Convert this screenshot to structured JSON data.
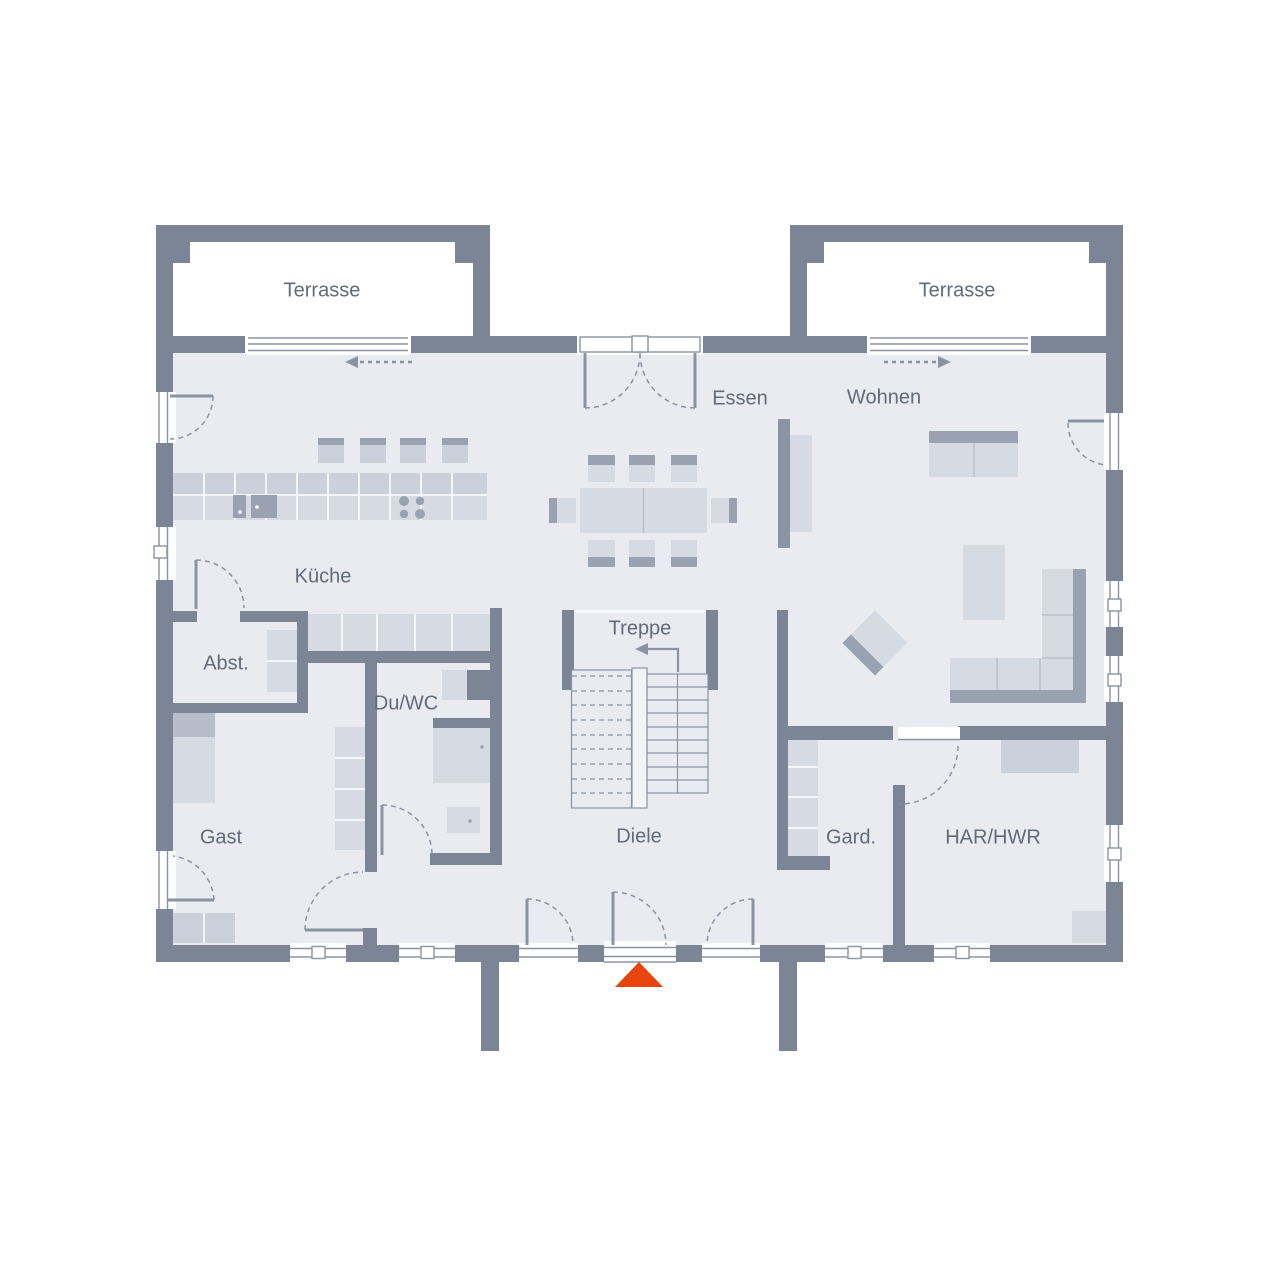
{
  "rooms": {
    "terrasse_left": "Terrasse",
    "terrasse_right": "Terrasse",
    "essen": "Essen",
    "wohnen": "Wohnen",
    "kueche": "Küche",
    "abstellraum": "Abst.",
    "du_wc": "Du/WC",
    "treppe": "Treppe",
    "gast": "Gast",
    "diele": "Diele",
    "garderobe": "Gard.",
    "har_hwr": "HAR/HWR"
  },
  "colors": {
    "wall": "#7c8596",
    "floor": "#e9ebf1",
    "furniture_light": "#d6dae3",
    "furniture_mid": "#ccd0da",
    "furniture_dark": "#9aa2b2",
    "pillow": "#b6bcc9",
    "outline": "#8b93a3",
    "text": "#636a78",
    "entrance_marker": "#e8440e",
    "background": "#ffffff"
  },
  "markers": {
    "entrance_icon": "triangle-up",
    "terrace_left_slide_arrow": "dashed-arrow-left",
    "terrace_right_slide_arrow": "dashed-arrow-right",
    "stair_direction_icon": "arrow-up-then-left"
  }
}
